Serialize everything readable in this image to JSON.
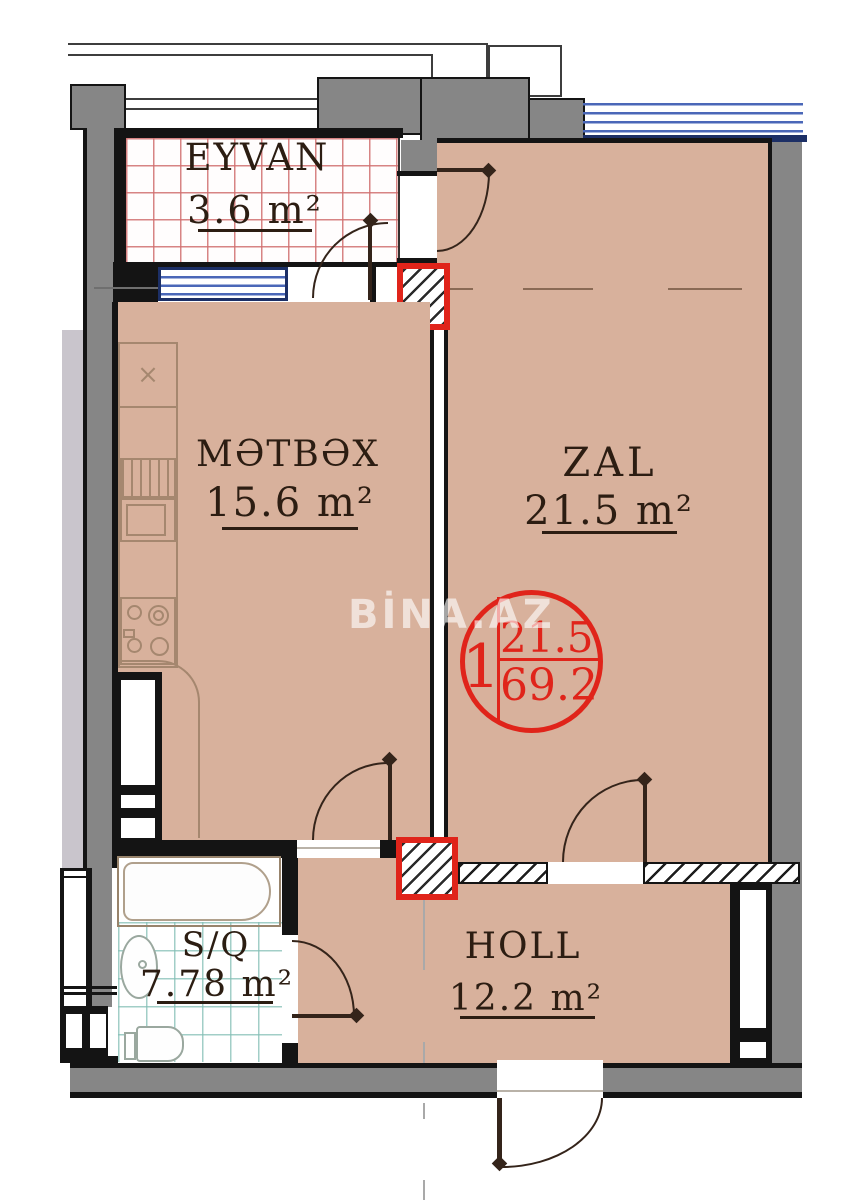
{
  "title": "Apartment floor plan",
  "watermark": "BİNA.AZ",
  "rooms": {
    "eyvan": {
      "name": "EYVAN",
      "area": "3.6 m²"
    },
    "metbex": {
      "name": "MƏTBƏX",
      "area": "15.6 m²"
    },
    "zal": {
      "name": "ZAL",
      "area": "21.5 m²"
    },
    "sq": {
      "name": "S/Q",
      "area": "7.78 m²"
    },
    "holl": {
      "name": "HOLL",
      "area": "12.2 m²"
    }
  },
  "stamp": {
    "unit_number": "1",
    "room_area": "21.5",
    "total_area": "69.2"
  },
  "fixtures": {
    "sink_mark": "×"
  },
  "colors": {
    "floor": "#d8b19c",
    "wall": "#868686",
    "line": "#141414",
    "red": "#e0241a",
    "blue": "#4a67b8",
    "navy": "#1c2f66",
    "text": "#2c1d12",
    "door": "#34241a",
    "fixture": "#a5876f",
    "light-strip": "#c9c5cc"
  }
}
